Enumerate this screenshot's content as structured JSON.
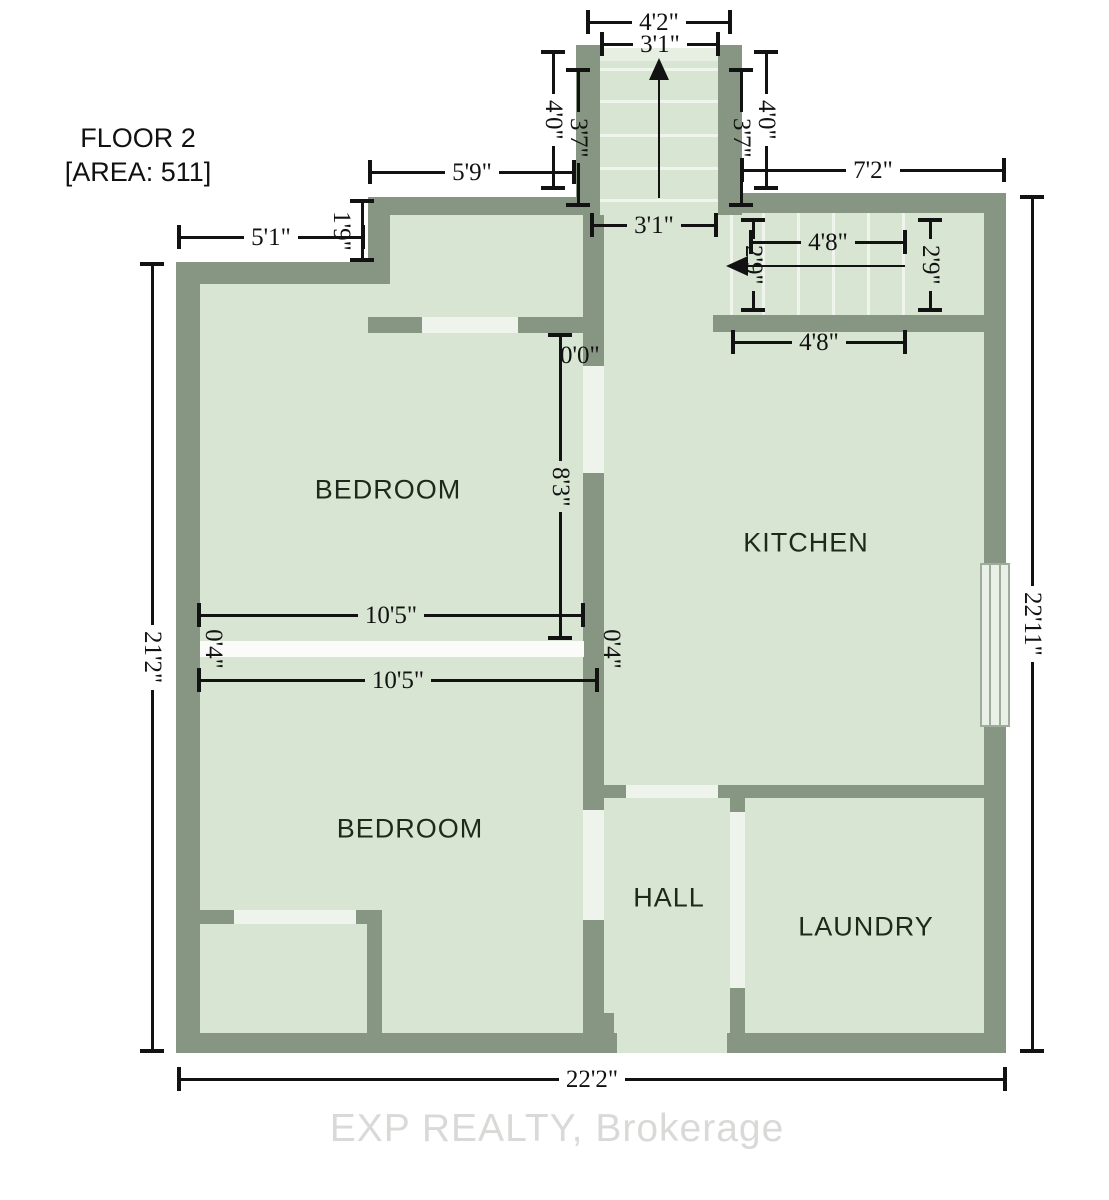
{
  "title": {
    "line1": "FLOOR 2",
    "line2": "[AREA: 511]"
  },
  "rooms": {
    "bedroom_upper": {
      "label": "BEDROOM"
    },
    "kitchen": {
      "label": "KITCHEN"
    },
    "bedroom_lower": {
      "label": "BEDROOM"
    },
    "hall": {
      "label": "HALL"
    },
    "laundry": {
      "label": "LAUNDRY"
    }
  },
  "dimensions": {
    "stair_outer_width": "4'2\"",
    "stair_inner_width_top": "3'1\"",
    "stair_left_outer_depth": "4'0\"",
    "stair_left_inner_depth": "3'7\"",
    "stair_right_outer_depth": "4'0\"",
    "stair_right_inner_depth": "3'7\"",
    "stair_inner_width_bottom": "3'1\"",
    "top_left_wall": "5'9\"",
    "top_right_wall": "7'2\"",
    "upper_left_wall": "5'1\"",
    "wall_step": "1'9\"",
    "kitchen_stair_width_top": "4'8\"",
    "kitchen_stair_depth_left": "2'9\"",
    "kitchen_stair_depth_right": "2'9\"",
    "kitchen_stair_width_bottom": "4'8\"",
    "zero_offset": "0'0\"",
    "bedroom_upper_depth": "8'3\"",
    "bedroom_upper_width": "10'5\"",
    "divider_left": "0'4\"",
    "divider_right": "0'4\"",
    "bedroom_lower_width": "10'5\"",
    "left_total_height": "21'2\"",
    "right_total_height": "22'11\"",
    "bottom_total_width": "22'2\""
  },
  "watermark": "EXP REALTY, Brokerage",
  "colors": {
    "wall": "#879682",
    "floor": "#d8e5d3",
    "opening": "#eef3ec",
    "divider": "#fbfcfa",
    "tread": "#eff5ed",
    "landing": "#e7efe3",
    "dim": "#121212",
    "label": "#1b2a1b",
    "watermark": "#d9d9d7",
    "window-fill": "#e8f0e7",
    "window-frame": "#a0ac9b"
  }
}
